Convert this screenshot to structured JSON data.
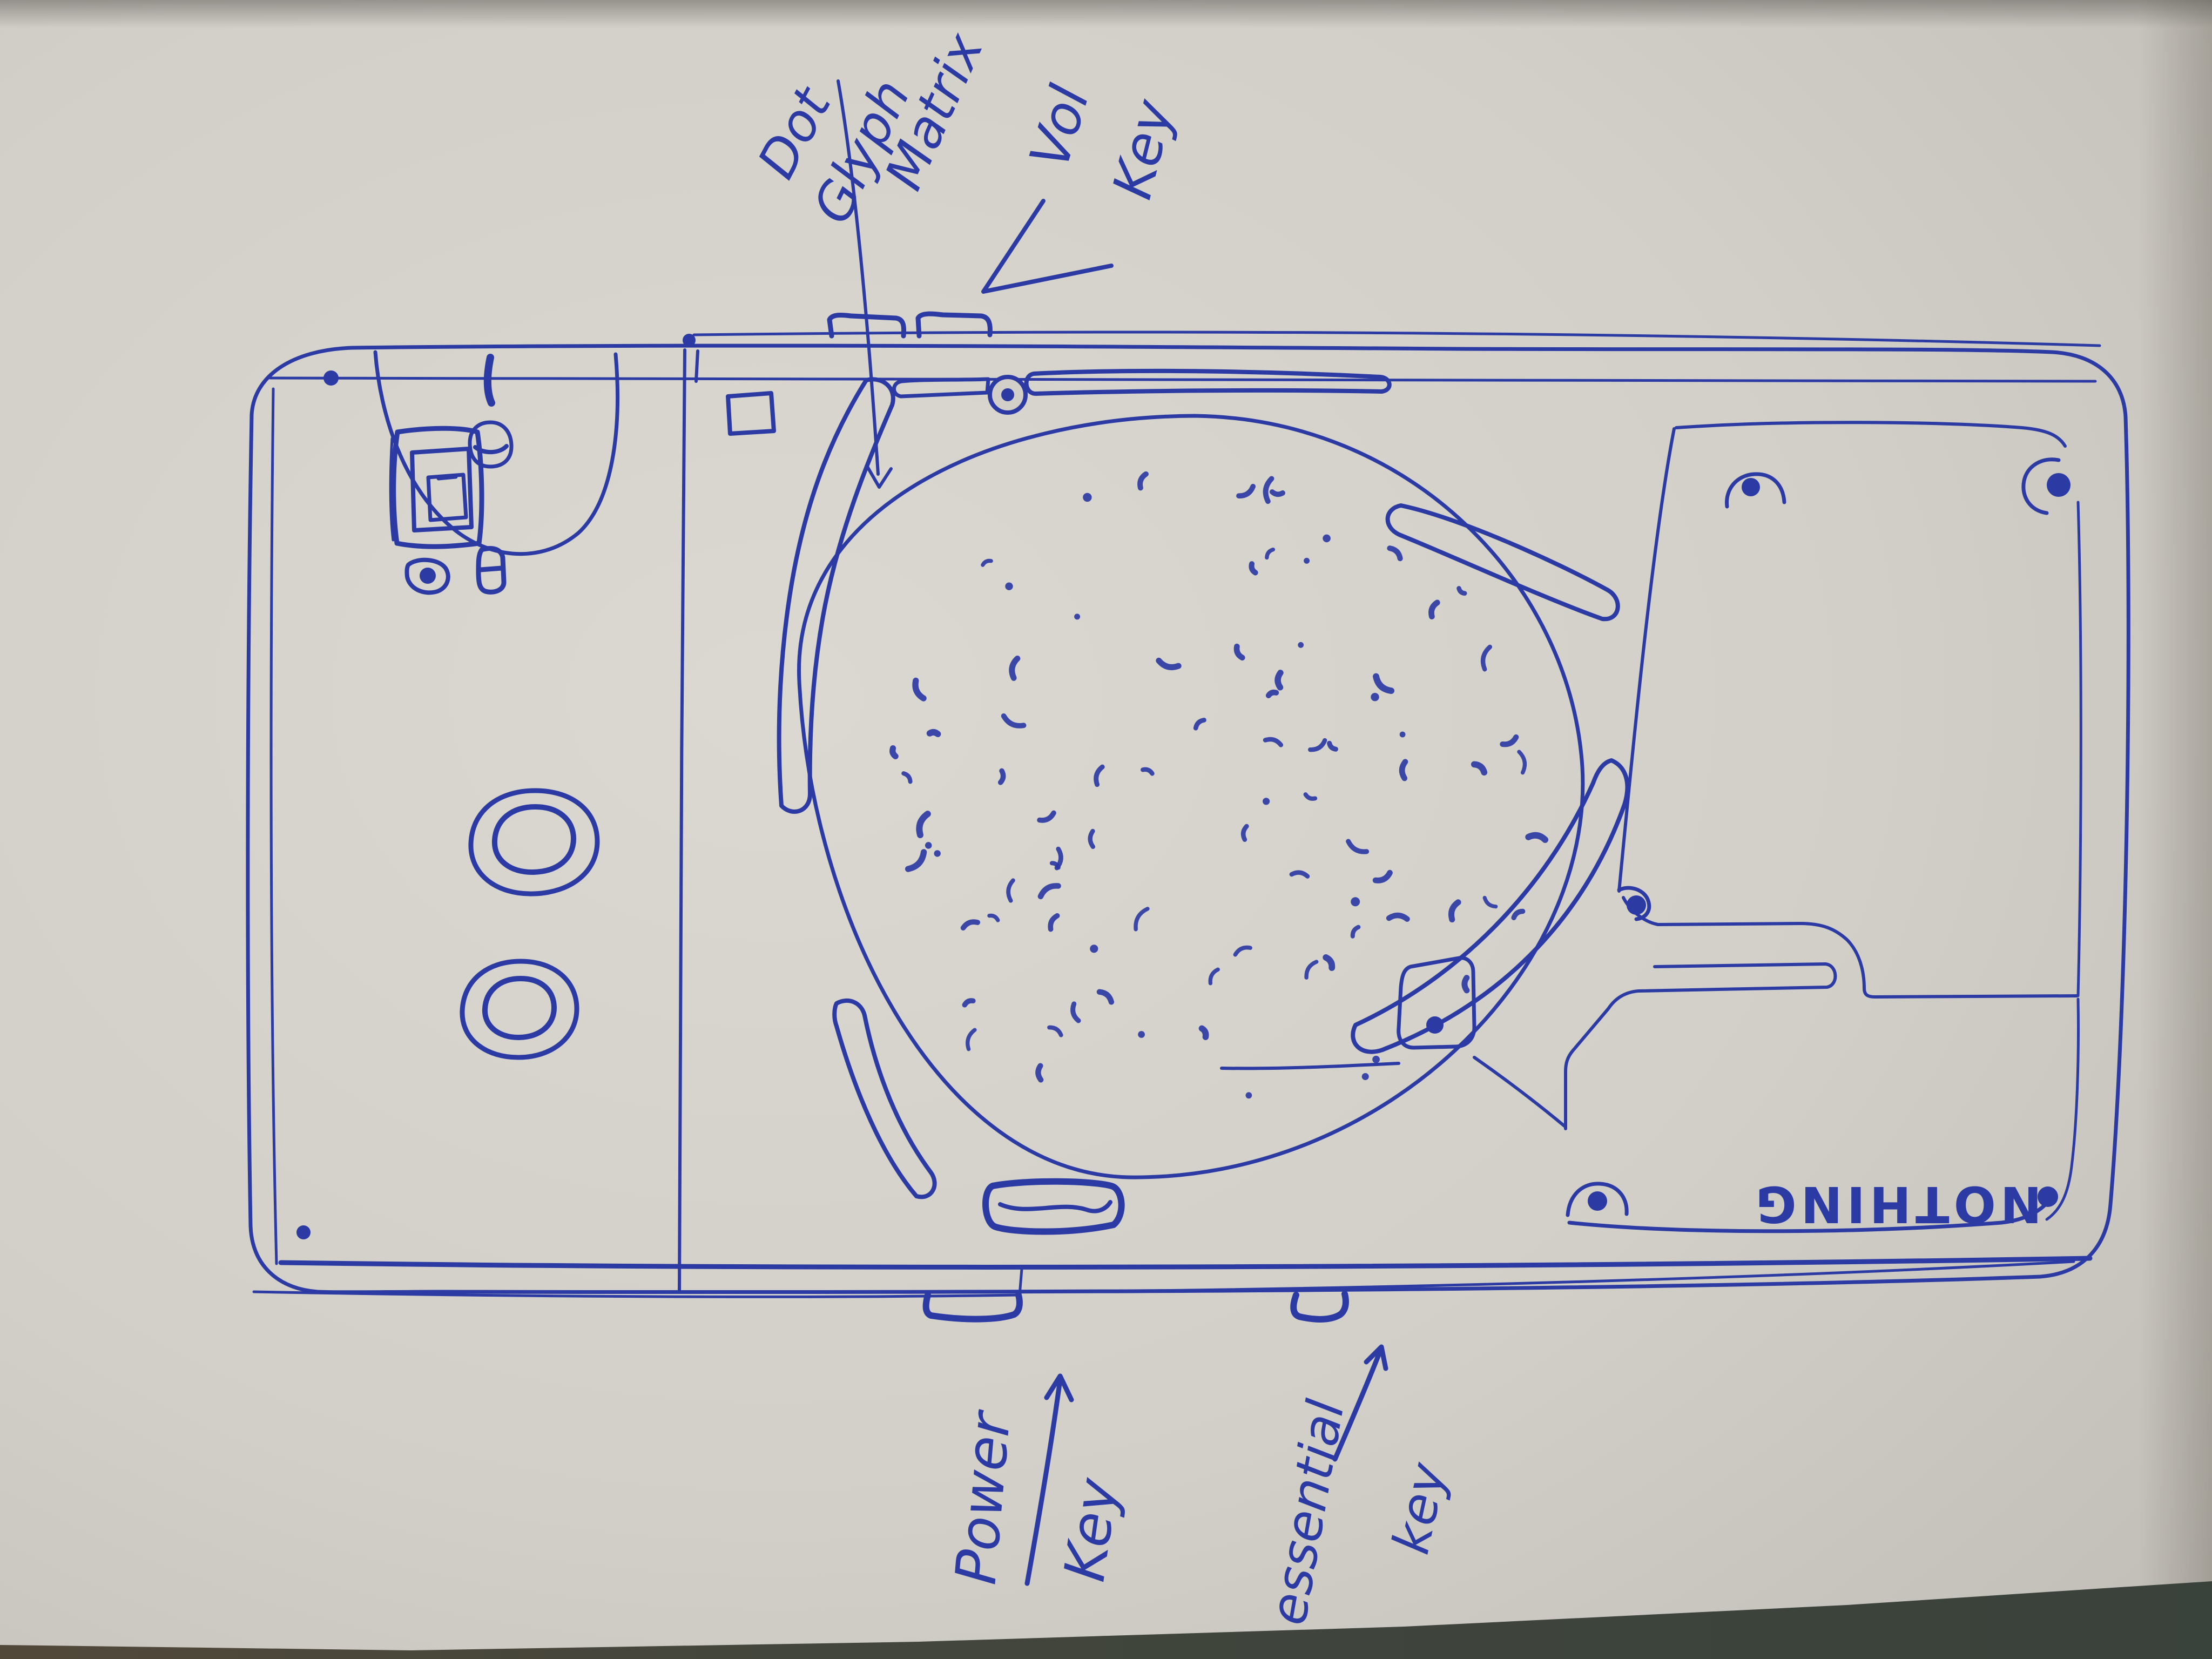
{
  "meta": {
    "title": "Hand-drawn ballpoint sketch of a phone rear (landscape) on paper",
    "medium": "blue pen on off-white paper"
  },
  "wordmark": {
    "text": "NOTHING",
    "orientation": "rotated-180"
  },
  "annotations": {
    "glyph_matrix": {
      "words": [
        "Dot",
        "Glyph",
        "Matrix"
      ],
      "target": "circular dot-matrix glyph area"
    },
    "volume": {
      "words": [
        "Vol",
        "Key"
      ],
      "target": "volume keys on top edge"
    },
    "power": {
      "words": [
        "Power",
        "Key"
      ],
      "target": "power key on bottom edge"
    },
    "essential": {
      "words": [
        "essential",
        "key"
      ],
      "target": "essential key on bottom edge"
    }
  },
  "colors": {
    "ink": "#2c3ba4",
    "paper": "#d2cfc8",
    "paper_bright": "#dbd8d1",
    "paper_dim": "#bfbcb5",
    "table_dark": "#39423b",
    "table_brown": "#52483a"
  }
}
